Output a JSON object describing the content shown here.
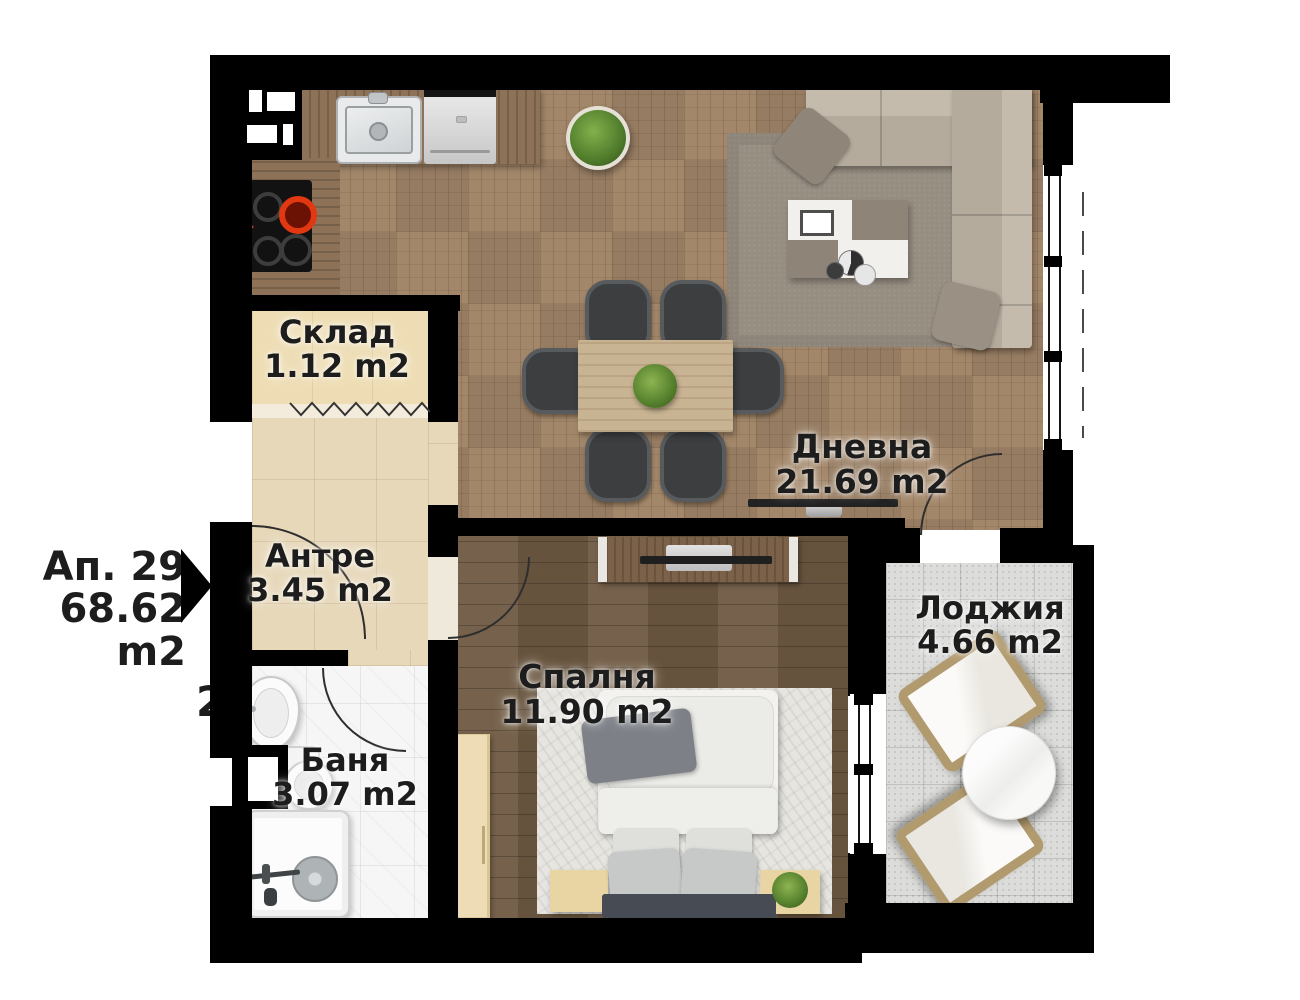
{
  "plan": {
    "apartment": {
      "number": "Ап. 29",
      "area": "68.62 m2"
    },
    "rooms": [
      {
        "key": "storage",
        "name": "Склад",
        "area": "1.12 m2"
      },
      {
        "key": "entry",
        "name": "Антре",
        "area": "3.45 m2"
      },
      {
        "key": "living",
        "name": "Дневна",
        "area": "21.69 m2"
      },
      {
        "key": "loggia",
        "name": "Лоджия",
        "area": "4.66 m2"
      },
      {
        "key": "bedroom",
        "name": "Спалня",
        "area": "11.90 m2"
      },
      {
        "key": "bathroom",
        "name": "Баня",
        "area": "3.07 m2"
      }
    ],
    "edge_fragment": "2",
    "colors": {
      "wall": "#000000",
      "label_text": "#1d1d1d",
      "parquet_floor": "#a3876a",
      "bedroom_floor": "#6f5a42",
      "entry_floor": "#e7d8ba",
      "storage_floor": "#eeddb4",
      "bathroom_floor": "#f6f6f6",
      "loggia_floor": "#dcdcda",
      "sofa": "#b9b0a2",
      "burner_accent": "#e23812",
      "plant_green": "#4e7a2a"
    }
  }
}
